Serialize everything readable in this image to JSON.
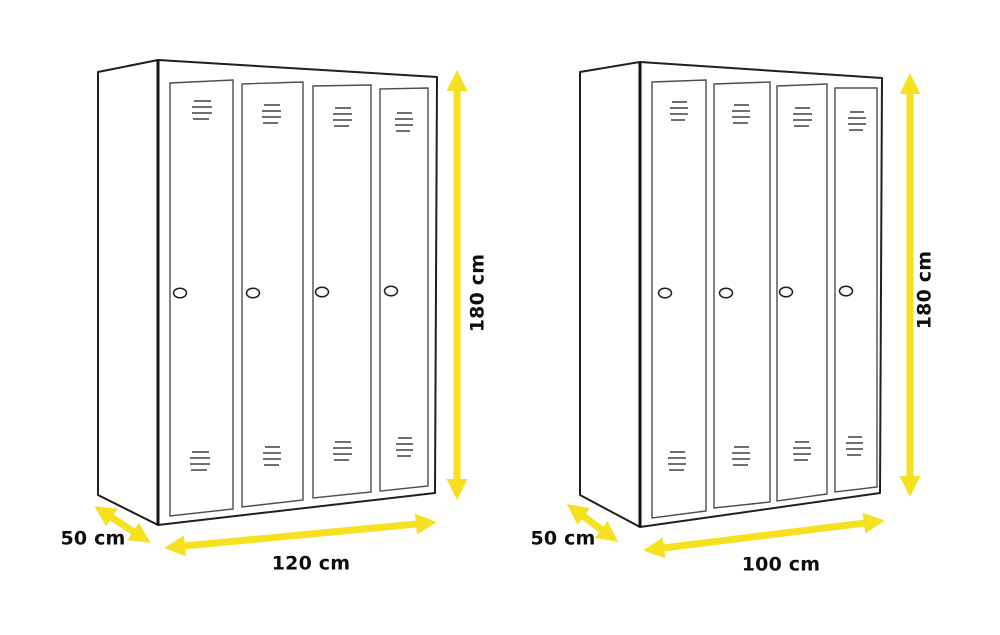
{
  "background": "#ffffff",
  "colors": {
    "arrow_yellow": "#F6E120",
    "outline": "#1f1f1f",
    "door_outline": "#4d4d4d",
    "vent_gray": "#5c5c5c",
    "label_text": "#0d0d0d"
  },
  "figures": [
    {
      "id": "locker-120",
      "doors": 4,
      "height_label": "180 cm",
      "width_label": "120 cm",
      "depth_label": "50 cm"
    },
    {
      "id": "locker-100",
      "doors": 4,
      "height_label": "180 cm",
      "width_label": "100 cm",
      "depth_label": "50 cm"
    }
  ]
}
